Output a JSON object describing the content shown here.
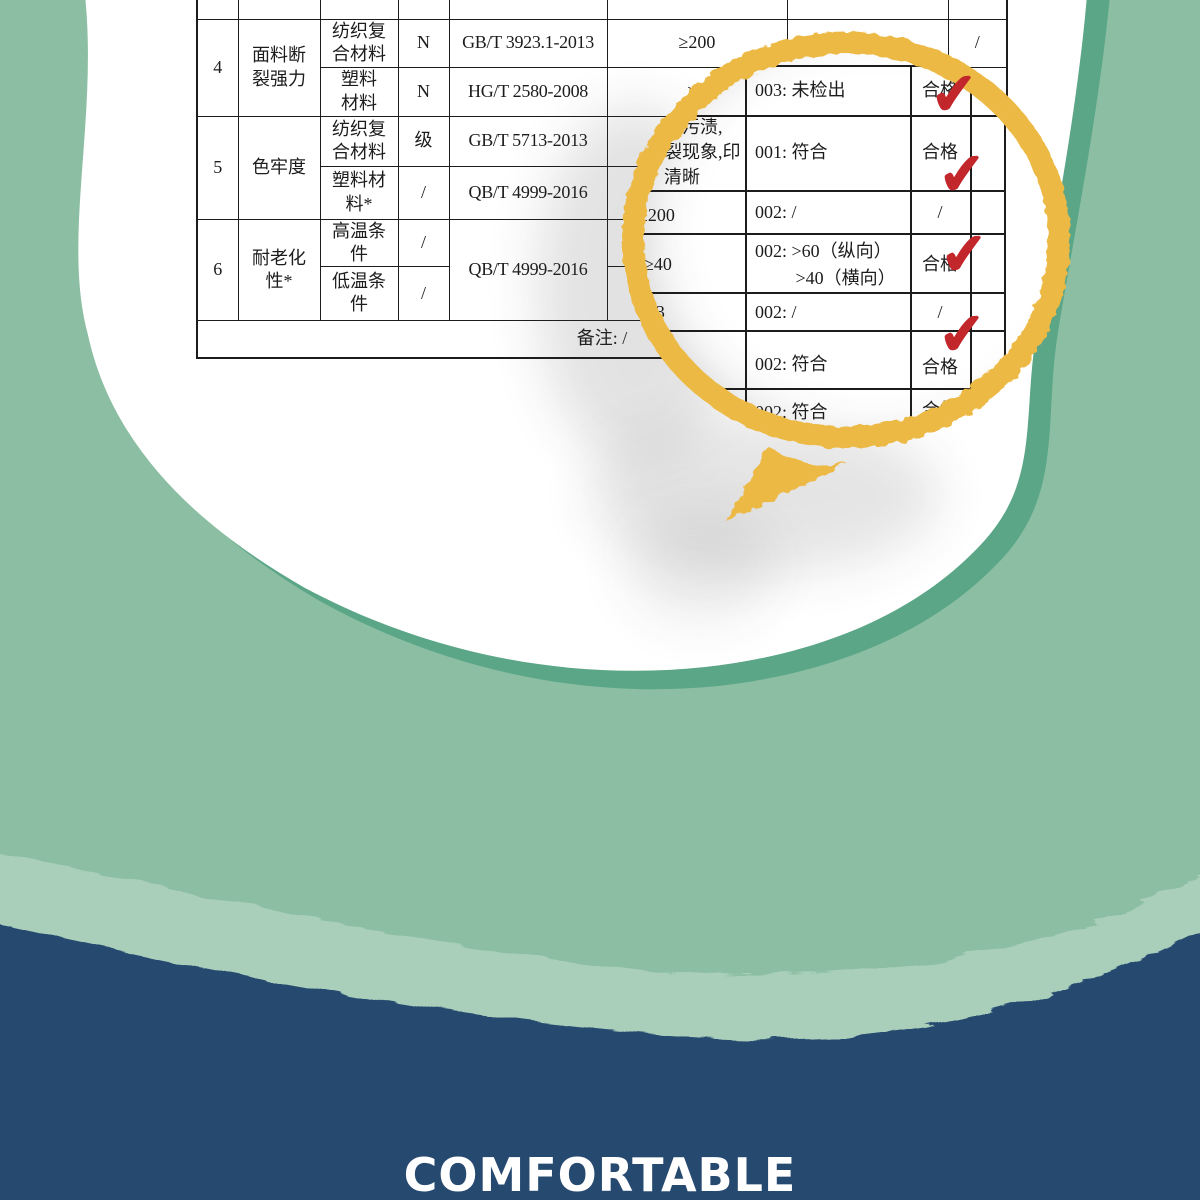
{
  "brand": {
    "watermark": "COMFORTABLE"
  },
  "colors": {
    "background_green": "#8BBEA2",
    "accent_green": "#5AA687",
    "mint_band": "#A9CFBA",
    "navy_band": "#264A70",
    "ring_yellow": "#EDB944",
    "check_red": "#C2272B",
    "paper_white": "#FFFFFF",
    "table_line": "#1C1C1C"
  },
  "icons": {
    "check_glyph": "✔"
  },
  "table": {
    "r0": {
      "req": "花清晰"
    },
    "r4a": {
      "no": "4",
      "item": "面料断\n裂强力",
      "sub": "纺织复\n合材料",
      "unit": "N",
      "std": "GB/T 3923.1-2013",
      "req": "≥200",
      "res": "0",
      "con": "/"
    },
    "r4b": {
      "sub": "塑料\n材料",
      "unit": "N",
      "std": "HG/T 2580-2008",
      "req": "≥4"
    },
    "r5a": {
      "no": "5",
      "item": "色牢度",
      "sub": "纺织复\n合材料",
      "unit": "级",
      "std": "GB/T 5713-2013"
    },
    "r5b": {
      "sub": "塑料材\n料*",
      "unit": "/",
      "std": "QB/T 4999-2016"
    },
    "r6a": {
      "no": "6",
      "item": "耐老化\n性*",
      "sub": "高温条\n件",
      "unit": "/",
      "std": "QB/T 4999-2016",
      "req": "不"
    },
    "r6b": {
      "sub": "低温条\n件",
      "unit": "/"
    },
    "remark": "备注: /"
  },
  "magnifier": {
    "rows": [
      {
        "req": "",
        "res": "003: 未检出",
        "con": "合格"
      },
      {
        "req": "无污渍,\n裂现象,印\n清晰",
        "res": "001: 符合",
        "con": "合格"
      },
      {
        "req": "≥200",
        "res": "002: /",
        "con": "/"
      },
      {
        "req": "≥40",
        "res": "002: >60（纵向）\n         >40（横向）",
        "con": "合格"
      },
      {
        "req": "≥3",
        "res": "002: /",
        "con": "/"
      },
      {
        "req": "色",
        "res": "002: 符合",
        "con": "合格"
      },
      {
        "req": "或水",
        "res": "002: 符合",
        "con": "合格"
      }
    ]
  }
}
